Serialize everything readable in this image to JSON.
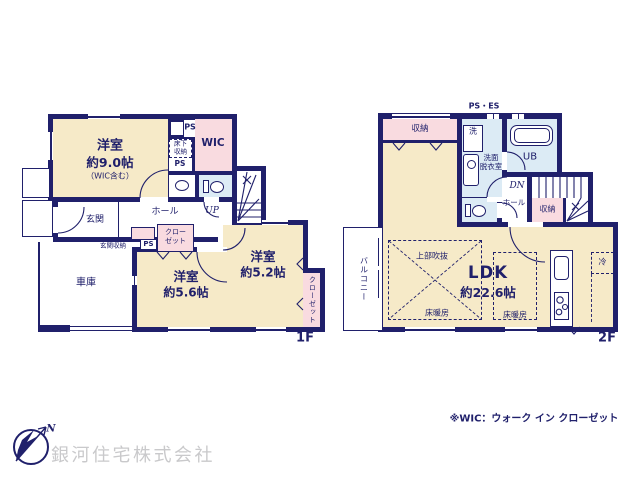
{
  "floor1": {
    "floor_label": "1F",
    "room_main": {
      "name": "洋室",
      "size": "約9.0帖",
      "note": "（WIC含む）"
    },
    "wic": "WIC",
    "ps_top": "PS",
    "underfloor_l1": "床下",
    "underfloor_l2": "収納",
    "ps_mid": "PS",
    "up": "UP",
    "genkan": "玄関",
    "hall": "ホール",
    "genkan_storage": "玄関収納",
    "ps_hall": "PS",
    "closet_l1": "クロー",
    "closet_l2": "ゼット",
    "room_56": {
      "name": "洋室",
      "size": "約5.6帖"
    },
    "room_52": {
      "name": "洋室",
      "size": "約5.2帖"
    },
    "closet_vertical": "クローゼット",
    "garage": "車庫"
  },
  "floor2": {
    "floor_label": "2F",
    "ps_es": "PS・ES",
    "storage_top": "収納",
    "washer": "洗",
    "washroom_l1": "洗面",
    "washroom_l2": "脱衣室",
    "ub": "UB",
    "dn": "DN",
    "hall": "ホール",
    "storage_right": "収納",
    "balcony": "バルコニー",
    "void_label": "上部吹抜",
    "ldk": {
      "name": "LDK",
      "size": "約22.6帖"
    },
    "heat1": "床暖房",
    "heat2": "床暖房",
    "fridge": "冷"
  },
  "footer": {
    "north": "N",
    "company": "銀河住宅株式会社",
    "wic_note": "※WIC：ウォーク イン クローゼット"
  },
  "colors": {
    "wall": "#20206b",
    "room": "#f6eac8",
    "closet": "#f9dbe0",
    "wet": "#dcebf5",
    "company_text": "#c9c9cb"
  }
}
